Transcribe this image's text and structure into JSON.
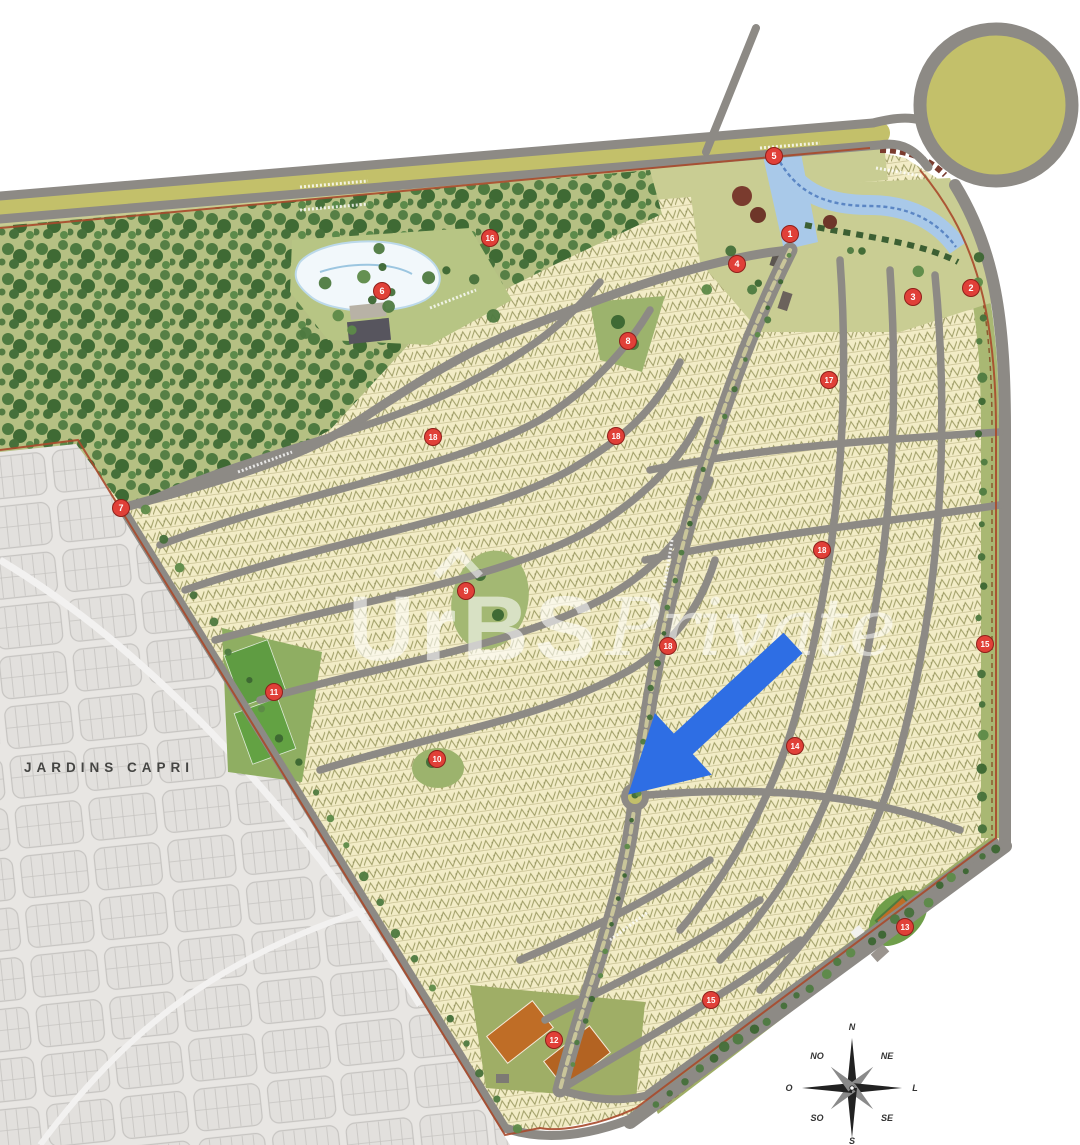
{
  "page": {
    "background": "#ffffff"
  },
  "map": {
    "neighboring_area_label": "JARDINS CAPRI",
    "watermark": {
      "brand": "UrBS",
      "script": "Private"
    },
    "colors": {
      "lot_fill": "#f2ecc6",
      "lot_hatch": "#8f8f54",
      "road_gray": "#8d8a85",
      "grass_olive": "#c9cd93",
      "forest_green": "#4e7a40",
      "roundabout_fill": "#c3c06a",
      "water_blue": "#a9c9e9",
      "boundary_red": "#a8492b",
      "marker_red": "#e04038",
      "arrow_blue": "#2e6ee4",
      "neighbor_gray": "#e8e6e3",
      "court_orange": "#bf6d26",
      "field_green": "#5f9c42"
    },
    "markers": [
      {
        "n": "5",
        "x": 774,
        "y": 156
      },
      {
        "n": "1",
        "x": 790,
        "y": 234
      },
      {
        "n": "4",
        "x": 737,
        "y": 264
      },
      {
        "n": "16",
        "x": 490,
        "y": 238
      },
      {
        "n": "6",
        "x": 382,
        "y": 291
      },
      {
        "n": "3",
        "x": 913,
        "y": 297
      },
      {
        "n": "2",
        "x": 971,
        "y": 288
      },
      {
        "n": "8",
        "x": 628,
        "y": 341
      },
      {
        "n": "17",
        "x": 829,
        "y": 380
      },
      {
        "n": "18",
        "x": 433,
        "y": 437
      },
      {
        "n": "18",
        "x": 616,
        "y": 436
      },
      {
        "n": "7",
        "x": 121,
        "y": 508
      },
      {
        "n": "18",
        "x": 822,
        "y": 550
      },
      {
        "n": "9",
        "x": 466,
        "y": 591
      },
      {
        "n": "15",
        "x": 985,
        "y": 644
      },
      {
        "n": "18",
        "x": 668,
        "y": 646
      },
      {
        "n": "11",
        "x": 274,
        "y": 692
      },
      {
        "n": "14",
        "x": 795,
        "y": 746
      },
      {
        "n": "10",
        "x": 437,
        "y": 759
      },
      {
        "n": "13",
        "x": 905,
        "y": 927
      },
      {
        "n": "15",
        "x": 711,
        "y": 1000
      },
      {
        "n": "12",
        "x": 554,
        "y": 1040
      }
    ],
    "compass": {
      "center": {
        "x": 852,
        "y": 1088
      },
      "points": [
        {
          "label": "N",
          "x": 852,
          "y": 1030
        },
        {
          "label": "NE",
          "x": 887,
          "y": 1059
        },
        {
          "label": "L",
          "x": 915,
          "y": 1091
        },
        {
          "label": "SE",
          "x": 887,
          "y": 1121
        },
        {
          "label": "S",
          "x": 852,
          "y": 1144
        },
        {
          "label": "SO",
          "x": 817,
          "y": 1121
        },
        {
          "label": "O",
          "x": 789,
          "y": 1091
        },
        {
          "label": "NO",
          "x": 817,
          "y": 1059
        }
      ]
    }
  }
}
